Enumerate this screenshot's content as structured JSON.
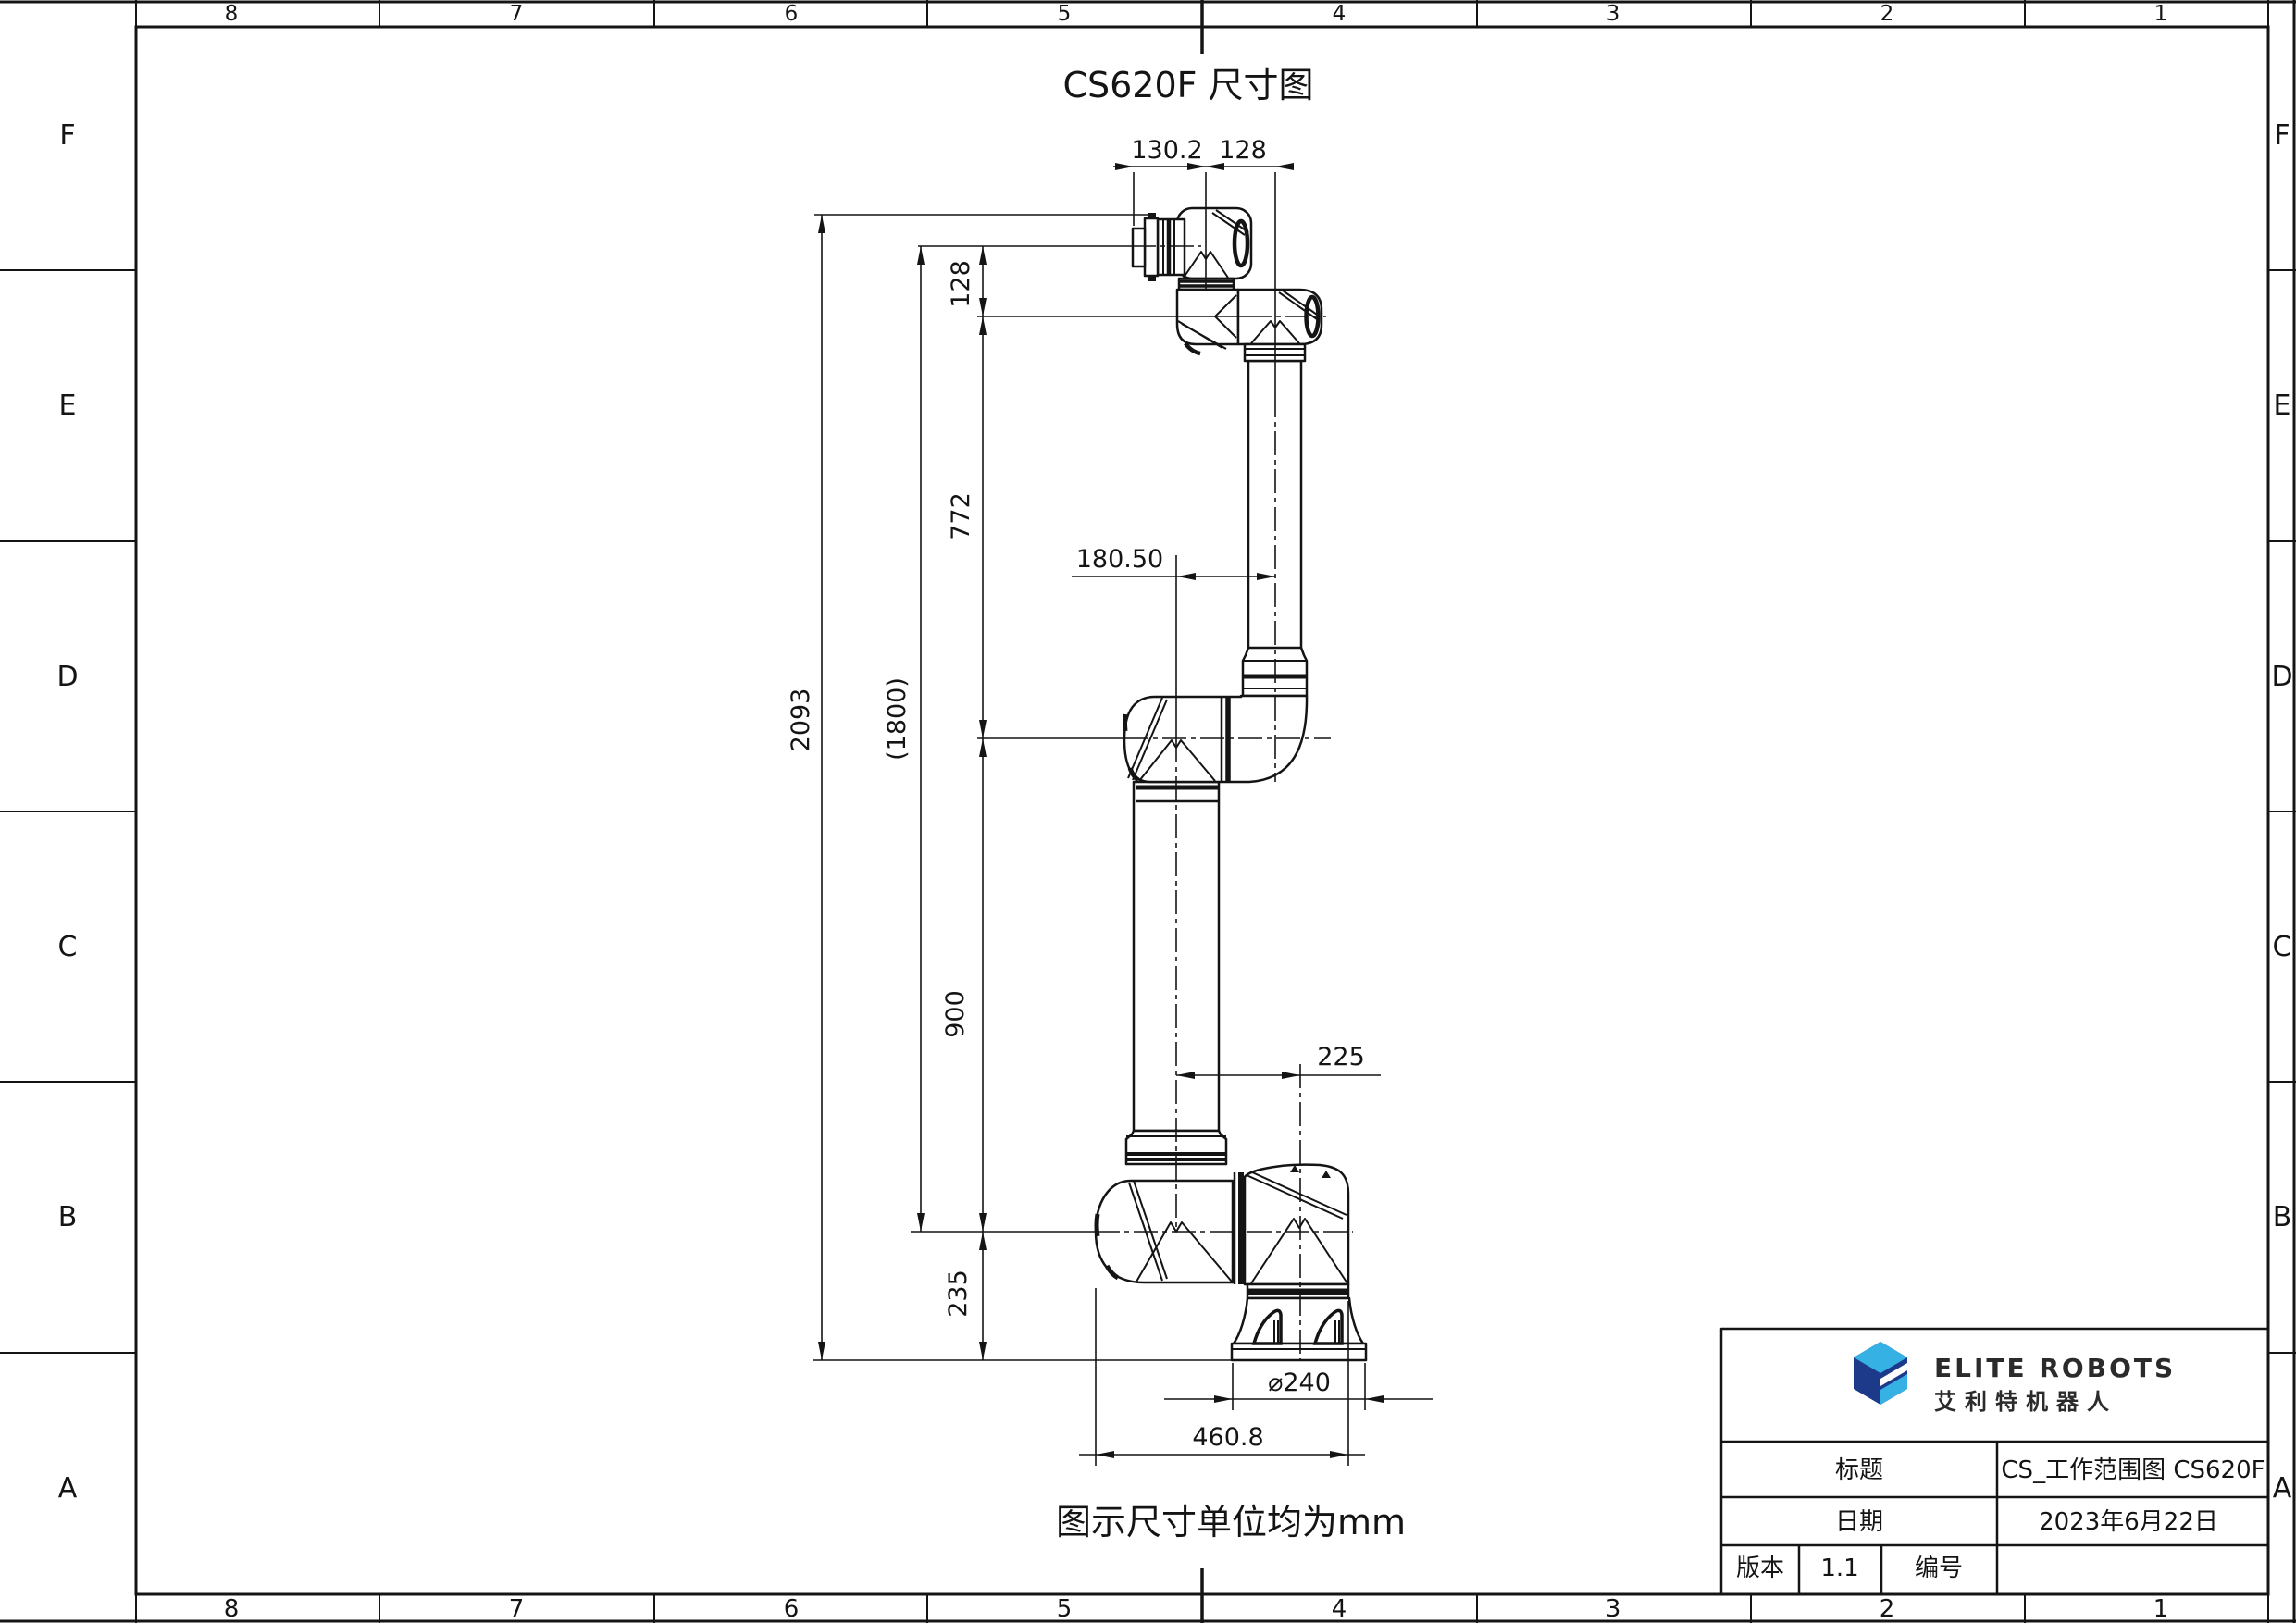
{
  "sheet": {
    "columns": [
      "8",
      "7",
      "6",
      "5",
      "4",
      "3",
      "2",
      "1"
    ],
    "rows": [
      "F",
      "E",
      "D",
      "C",
      "B",
      "A"
    ]
  },
  "title": "CS620F 尺寸图",
  "note": "图示尺寸单位均为mm",
  "dimensions": {
    "top_flange_offset": "130.2",
    "top_wrist_offset": "128",
    "flange_to_wrist_height": "128",
    "wrist_to_elbow": "772",
    "overall_height": "2093",
    "flange_to_shoulder": "(1800)",
    "elbow_offset": "180.50",
    "elbow_to_shoulder": "900",
    "shoulder_to_ground": "235",
    "arm_to_base_offset": "225",
    "base_diameter": "⌀240",
    "base_overall_width": "460.8"
  },
  "title_block": {
    "logo_text_en": "ELITE ROBOTS",
    "logo_text_cn": "艾利特机器人",
    "title_label": "标题",
    "title_value": "CS_工作范围图 CS620F",
    "date_label": "日期",
    "date_value": "2023年6月22日",
    "version_label": "版本",
    "version_value": "1.1",
    "number_label": "编号",
    "number_value": ""
  },
  "colors": {
    "logo_dark_blue": "#1d3a8a",
    "logo_light_blue": "#35b1e4",
    "line": "#141414"
  }
}
